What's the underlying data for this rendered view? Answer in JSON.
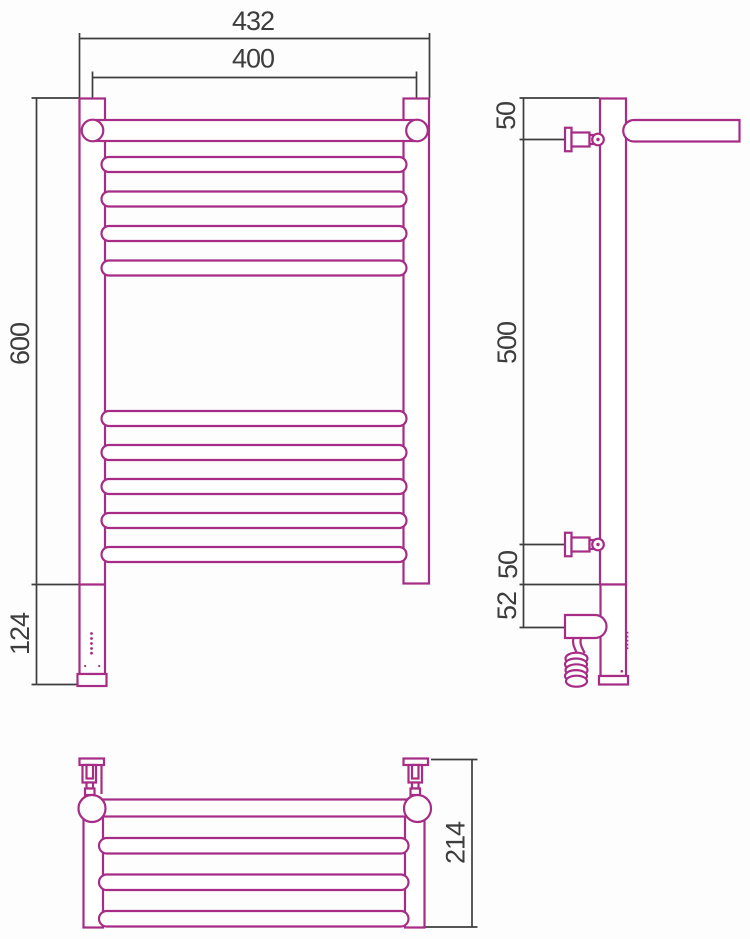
{
  "drawing_title": "heated-towel-rail-with-shelf-three-view-dimension-drawing",
  "colors": {
    "outline": "#A62C85",
    "dimension": "#3D3D3D",
    "background": "#FDFDFD"
  },
  "dimensions": {
    "front": {
      "overall_width": "432",
      "axis_width": "400",
      "height": "600",
      "lower_section": "124"
    },
    "side": {
      "top_to_bracket": "50",
      "bracket_spacing": "500",
      "bracket_to_base": "50",
      "element_axis": "52"
    },
    "top": {
      "shelf_depth": "214"
    }
  }
}
